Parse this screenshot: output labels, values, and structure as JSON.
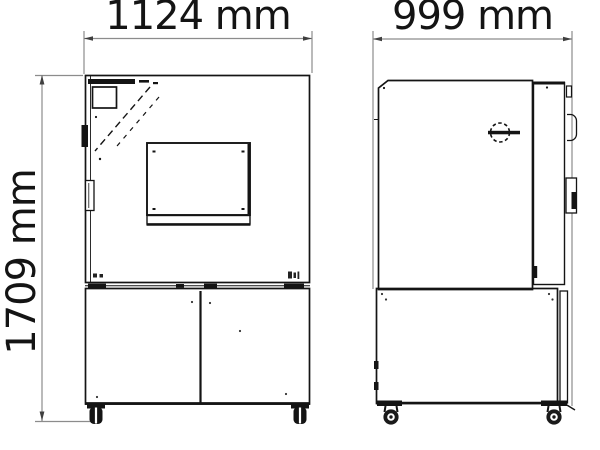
{
  "drawing": {
    "title": "Two-view dimensional technical drawing of a floor-standing cabinet (climate chamber)",
    "front_view": {
      "name": "front view",
      "width_label": "1124 mm",
      "height_label": "1709 mm"
    },
    "side_view": {
      "name": "side view",
      "depth_label": "999 mm"
    },
    "features": {
      "front": [
        "control-panel-display",
        "door-lock",
        "door-handle",
        "viewing-window",
        "window-sill",
        "lower-compartment-double-doors",
        "swivel-casters"
      ],
      "side": [
        "access-port",
        "door-slab",
        "door-hinges",
        "lower-compartment",
        "swivel-casters"
      ]
    },
    "colors": {
      "line": "#141414",
      "dimension_line": "#8c8c8c",
      "arrow": "#3f3f3f",
      "text": "#141414",
      "background": "#ffffff"
    }
  }
}
